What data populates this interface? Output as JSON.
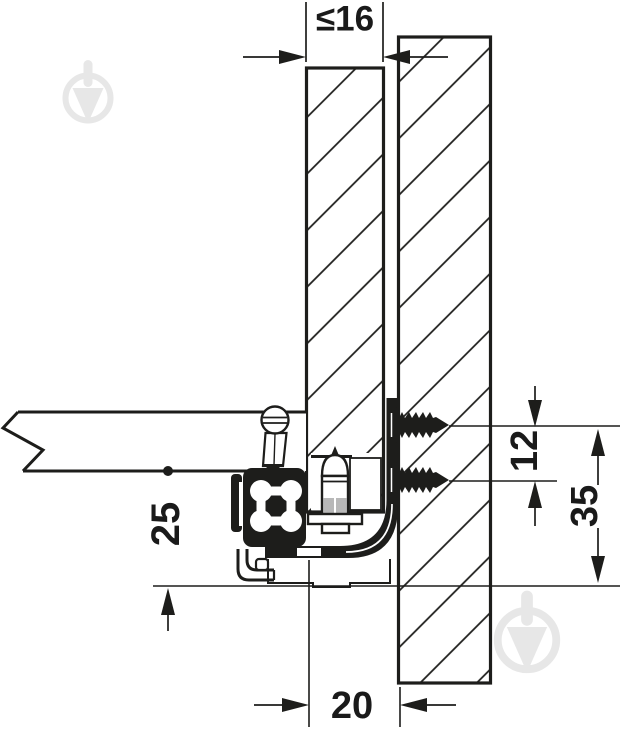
{
  "drawing": {
    "type": "technical-mounting-diagram",
    "dimensions": {
      "panel_thickness": "≤16",
      "screw_spacing": "12",
      "bracket_height": "35",
      "side_inset": "25",
      "bottom_inset": "20"
    },
    "colors": {
      "ink": "#1d1d1b",
      "background": "#ffffff",
      "watermark": "#e7e7e7",
      "thread_shading": "#b8b8b8"
    },
    "icons": {
      "watermark": "trowel-in-circle-icon"
    }
  }
}
